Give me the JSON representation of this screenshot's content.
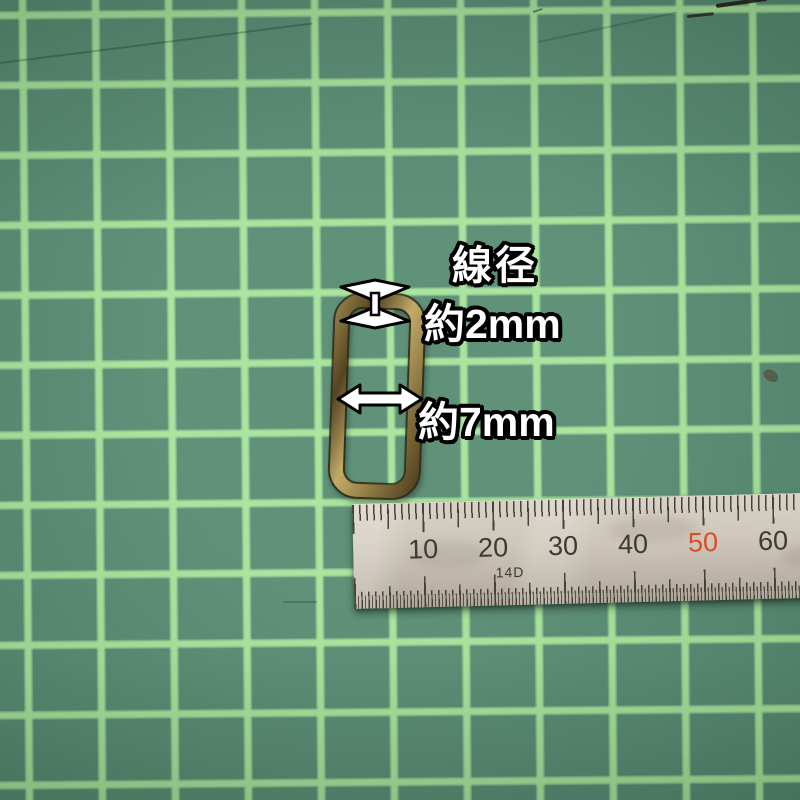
{
  "photo": {
    "subject": "rectangle-wire-ring",
    "annotations": {
      "wire_label": "線径",
      "wire_value": "約2mm",
      "width_value": "約7mm"
    },
    "ruler": {
      "unit_labels": [
        "10",
        "20",
        "30",
        "40",
        "50",
        "60"
      ],
      "highlighted_label": "50",
      "stamp": "14D"
    },
    "colors": {
      "mat": "#578b72",
      "grid_line": "#a6e49a",
      "ring_brass_light": "#c2aa68",
      "ring_brass_mid": "#8f7a44",
      "ring_brass_dark": "#554421",
      "ruler_steel_light": "#d9d2c6",
      "ruler_steel_dark": "#b0a89b",
      "ruler_tick": "#46423a",
      "ruler_number": "#3d3a33",
      "ruler_number_highlight": "#e04a28",
      "annotation_fill": "#ffffff",
      "annotation_outline": "#000000"
    }
  }
}
